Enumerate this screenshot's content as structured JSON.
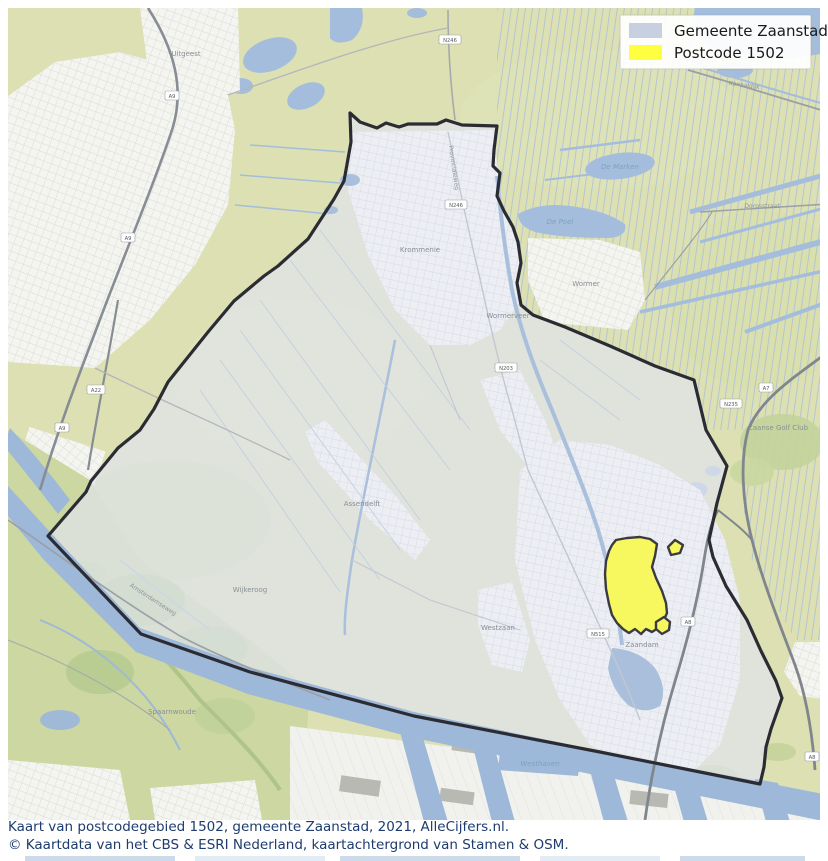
{
  "legend": {
    "items": [
      {
        "id": "gemeente",
        "label": "Gemeente Zaanstad",
        "color": "#c7d0e0"
      },
      {
        "id": "postcode",
        "label": "Postcode 1502",
        "color": "#ffff42"
      }
    ]
  },
  "caption": {
    "line1": "Kaart van postcodegebied 1502, gemeente Zaanstad, 2021, AlleCijfers.nl.",
    "line2": "© Kaartdata van het CBS & ESRI Nederland, kaartachtergrond van Stamen & OSM."
  },
  "map": {
    "colors": {
      "municipality_fill": "rgba(223,228,236,0.70)",
      "municipality_stroke": "#2b2c33",
      "postcode_fill": "#f7f75f",
      "postcode_stroke": "#3a3b41",
      "water": "#a4bddc",
      "base_green": "#dce0b2"
    },
    "geometry": {
      "boundary": "350,113 360,122 377,128 386,123 399,127 408,124 437,124 446,120 462,125 497,126 494,150 493,166 500,173 497,196 504,211 513,227 518,242 521,263 517,283 521,305 533,315 565,327 610,346 655,366 694,380 706,430 727,466 717,503 709,540 713,557 726,586 747,620 761,651 776,681 782,698 771,729 766,747 764,767 760,784 600,752 414,716 250,672 141,634 48,536 86,492 91,481 118,448 140,430 154,409 168,382 188,357 208,332 234,301 264,276 278,266 308,239 334,199 344,181 351,142",
      "postcode_main": "612,545 616,540 627,538 640,537 650,539 657,544 655,556 652,567 656,578 662,591 666,603 667,613 663,622 658,628 652,632 646,629 641,634 635,629 629,633 623,629 617,623 612,615 609,604 606,589 605,574 606,561 609,551",
      "postcode_tail": "656,622 664,617 670,622 669,630 662,634 656,629",
      "postcode_island": "668,547 675,540 683,545 680,553 671,555"
    },
    "labels": [
      {
        "t": "Uitgeestermeer",
        "x": 760,
        "y": 33,
        "cls": "water"
      },
      {
        "t": "De Marken",
        "x": 620,
        "y": 169,
        "cls": "water"
      },
      {
        "t": "De Poel",
        "x": 560,
        "y": 224,
        "cls": "water"
      },
      {
        "t": "Uitgeest",
        "x": 186,
        "y": 56,
        "cls": "town"
      },
      {
        "t": "Krommenie",
        "x": 420,
        "y": 252,
        "cls": "town"
      },
      {
        "t": "Wormerveer",
        "x": 508,
        "y": 318,
        "cls": "town"
      },
      {
        "t": "Wormer",
        "x": 586,
        "y": 286,
        "cls": "town"
      },
      {
        "t": "Assendelft",
        "x": 362,
        "y": 506,
        "cls": "town"
      },
      {
        "t": "Westzaan",
        "x": 498,
        "y": 630,
        "cls": "town"
      },
      {
        "t": "Zaandam",
        "x": 642,
        "y": 647,
        "cls": "town"
      },
      {
        "t": "Wijkeroog",
        "x": 250,
        "y": 592,
        "cls": "town"
      },
      {
        "t": "Spaarnwoude",
        "x": 172,
        "y": 714,
        "cls": "town"
      },
      {
        "t": "Zaanse Golf Club",
        "x": 778,
        "y": 430,
        "cls": "town"
      },
      {
        "t": "Westhaven",
        "x": 540,
        "y": 766,
        "cls": "water"
      },
      {
        "t": "Kanaaldijk",
        "x": 744,
        "y": 87,
        "cls": "road",
        "r": 8
      },
      {
        "t": "Dorpsstraat",
        "x": 762,
        "y": 208,
        "cls": "road"
      },
      {
        "t": "Provincialeweg",
        "x": 452,
        "y": 168,
        "cls": "road",
        "r": 82
      },
      {
        "t": "Amsterdamseweg",
        "x": 152,
        "y": 601,
        "cls": "road",
        "r": 33
      }
    ],
    "shields": [
      {
        "t": "A9",
        "x": 172,
        "y": 96
      },
      {
        "t": "A9",
        "x": 128,
        "y": 238
      },
      {
        "t": "A9",
        "x": 62,
        "y": 428
      },
      {
        "t": "A22",
        "x": 96,
        "y": 390
      },
      {
        "t": "N246",
        "x": 450,
        "y": 40
      },
      {
        "t": "N246",
        "x": 456,
        "y": 205
      },
      {
        "t": "N203",
        "x": 506,
        "y": 368
      },
      {
        "t": "A7",
        "x": 766,
        "y": 388
      },
      {
        "t": "N235",
        "x": 731,
        "y": 404
      },
      {
        "t": "A8",
        "x": 688,
        "y": 622
      },
      {
        "t": "N515",
        "x": 598,
        "y": 634
      },
      {
        "t": "A8",
        "x": 812,
        "y": 757
      }
    ]
  }
}
